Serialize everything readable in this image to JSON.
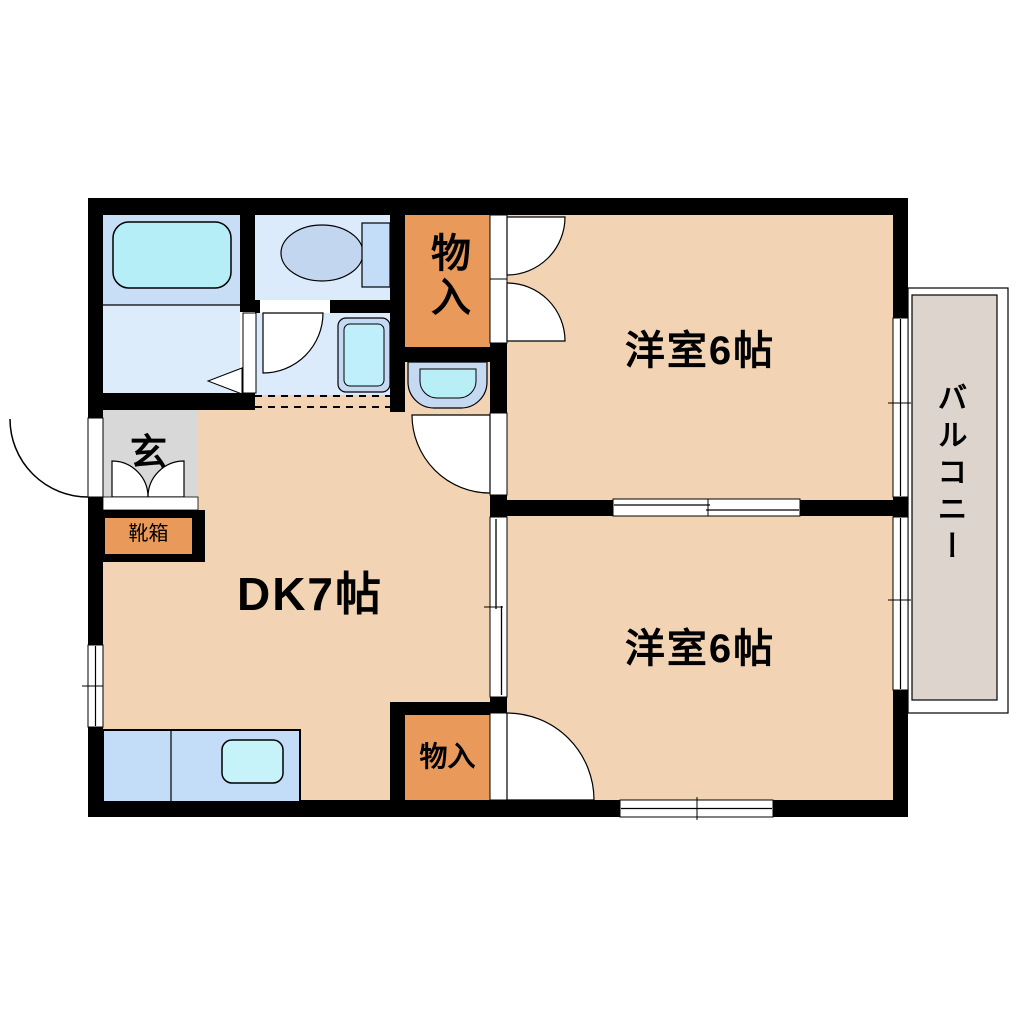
{
  "labels": {
    "room_top_right": "洋室6帖",
    "room_bottom_right": "洋室6帖",
    "dining_kitchen": "DK7帖",
    "balcony": "バルコニー",
    "entrance": "玄",
    "shoe_box": "靴箱",
    "closet_top": "物入",
    "closet_bottom": "物入"
  },
  "colors": {
    "wall": "#000000",
    "room_floor": "#f2d4b4",
    "closet_fill": "#e9995a",
    "entrance_floor": "#d8d8d8",
    "balcony_floor": "#ddd5cd",
    "bathroom_floor": "#c8ddf6",
    "sanitary_floor": "#dcebfb",
    "bathtub_fill": "#b5eef6",
    "fixture_frame_blue": "#c5d9f3",
    "fixture_cyan": "#bfeffa",
    "kitchen_counter": "#c3ddf9",
    "kitchen_sink": "#c5f3f9",
    "toilet_fill": "#c3d6f0",
    "toilet_tank": "#c3dcf7"
  }
}
